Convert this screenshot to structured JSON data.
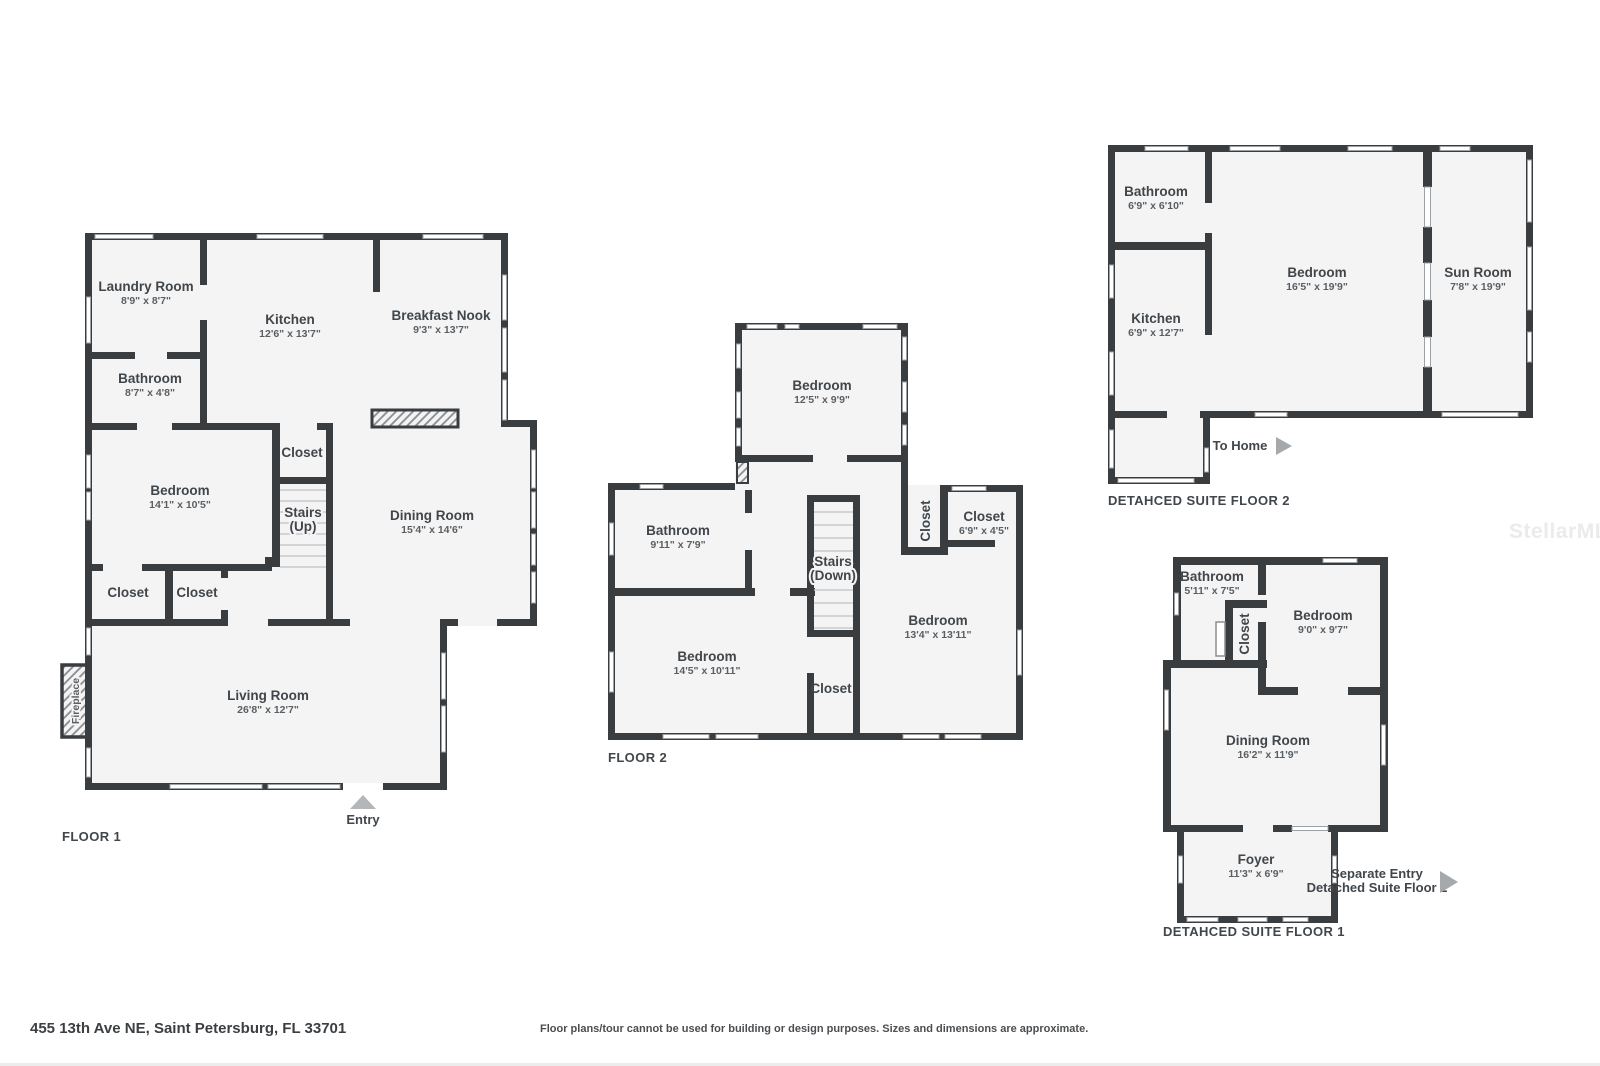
{
  "page": {
    "address": "455 13th Ave NE, Saint Petersburg, FL 33701",
    "disclaimer": "Floor plans/tour cannot be used for building or design purposes. Sizes and dimensions are approximate.",
    "watermark": "StellarMLS"
  },
  "colors": {
    "wall": "#3a3d40",
    "floor_fill": "#f4f4f4",
    "label": "#41464b",
    "window": "#ffffff",
    "arrow": "#a6a9ac",
    "watermark": "#ebebeb"
  },
  "floor1": {
    "label": "FLOOR 1",
    "laundry_name": "Laundry Room",
    "laundry_dims": "8'9\" x 8'7\"",
    "kitchen_name": "Kitchen",
    "kitchen_dims": "12'6\" x 13'7\"",
    "nook_name": "Breakfast Nook",
    "nook_dims": "9'3\" x 13'7\"",
    "bathroom_name": "Bathroom",
    "bathroom_dims": "8'7\" x 4'8\"",
    "bedroom_name": "Bedroom",
    "bedroom_dims": "14'1\" x 10'5\"",
    "closet_hall": "Closet",
    "stairs_name": "Stairs",
    "stairs_dir": "(Up)",
    "dining_name": "Dining Room",
    "dining_dims": "15'4\" x 14'6\"",
    "closet_left": "Closet",
    "closet_right": "Closet",
    "living_name": "Living Room",
    "living_dims": "26'8\" x 12'7\"",
    "fireplace": "Fireplace",
    "entry": "Entry"
  },
  "floor2": {
    "label": "FLOOR 2",
    "bedroom_top_name": "Bedroom",
    "bedroom_top_dims": "12'5\" x 9'9\"",
    "bathroom_name": "Bathroom",
    "bathroom_dims": "9'11\" x 7'9\"",
    "stairs_name": "Stairs",
    "stairs_dir": "(Down)",
    "closet_side": "Closet",
    "closet_right_name": "Closet",
    "closet_right_dims": "6'9\" x 4'5\"",
    "bedroom_right_name": "Bedroom",
    "bedroom_right_dims": "13'4\" x 13'11\"",
    "bedroom_left_name": "Bedroom",
    "bedroom_left_dims": "14'5\" x 10'11\"",
    "closet_bottom": "Closet"
  },
  "detached2": {
    "label": "DETAHCED SUITE FLOOR 2",
    "bathroom_name": "Bathroom",
    "bathroom_dims": "6'9\" x 6'10\"",
    "kitchen_name": "Kitchen",
    "kitchen_dims": "6'9\" x 12'7\"",
    "bedroom_name": "Bedroom",
    "bedroom_dims": "16'5\" x 19'9\"",
    "sunroom_name": "Sun Room",
    "sunroom_dims": "7'8\" x 19'9\"",
    "to_home": "To Home"
  },
  "detached1": {
    "label": "DETAHCED SUITE FLOOR 1",
    "bathroom_name": "Bathroom",
    "bathroom_dims": "5'11\" x 7'5\"",
    "closet": "Closet",
    "bedroom_name": "Bedroom",
    "bedroom_dims": "9'0\" x 9'7\"",
    "dining_name": "Dining Room",
    "dining_dims": "16'2\" x 11'9\"",
    "foyer_name": "Foyer",
    "foyer_dims": "11'3\" x 6'9\"",
    "separate_entry_1": "Separate Entry",
    "separate_entry_2": "Detached Suite Floor 2"
  }
}
